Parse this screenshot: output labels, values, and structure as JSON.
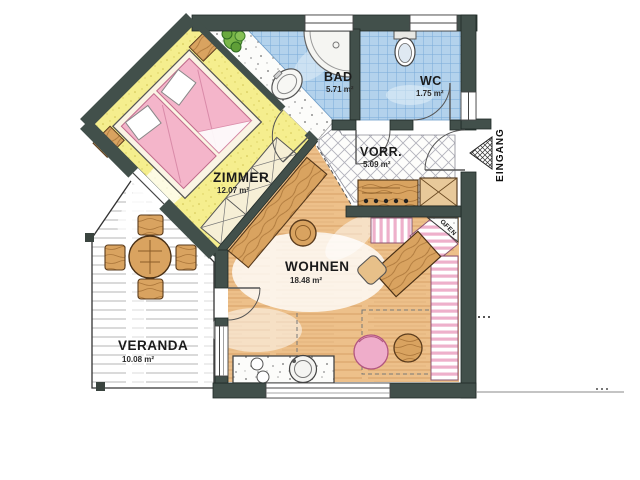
{
  "plan": {
    "rooms": [
      {
        "name": "ZIMMER",
        "area": "12.07 m²"
      },
      {
        "name": "BAD",
        "area": "5.71 m²"
      },
      {
        "name": "WC",
        "area": "1.75 m²"
      },
      {
        "name": "VORR.",
        "area": "5.09 m²"
      },
      {
        "name": "WOHNEN",
        "area": "18.48 m²"
      },
      {
        "name": "VERANDA",
        "area": "10.08 m²"
      }
    ],
    "labels": {
      "entrance": "EINGANG",
      "stove": "OFEN"
    },
    "colors": {
      "wall": "#42504b",
      "zimmer_floor": "#f5ee8e",
      "bathroom_tile": "#b3d2ec",
      "wohnen_floor": "#edc08a",
      "bed_pink": "#f4b5ca",
      "bench_pink": "#eeb0cb",
      "wood": "#d9a360",
      "plant_green": "#6fae4a",
      "paper": "#ffffff"
    }
  }
}
